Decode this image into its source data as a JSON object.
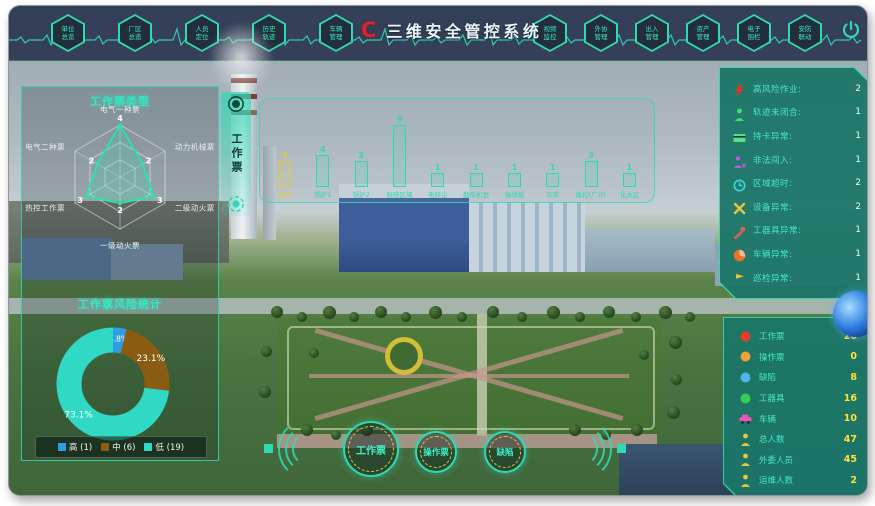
{
  "app": {
    "logo_text": "C",
    "title": "三维安全管控系统"
  },
  "top_nav": {
    "left_items": [
      {
        "label": "单位总览"
      },
      {
        "label": "厂区总览"
      },
      {
        "label": "人员定位"
      },
      {
        "label": "历史轨迹"
      },
      {
        "label": "车辆管理"
      }
    ],
    "right_items": [
      {
        "label": "视频监控"
      },
      {
        "label": "外协管理"
      },
      {
        "label": "出入管理"
      },
      {
        "label": "资产管理"
      },
      {
        "label": "电子围栏"
      },
      {
        "label": "安防联动"
      }
    ]
  },
  "side_tab": {
    "label": "工作票"
  },
  "chart_data": [
    {
      "type": "radar",
      "title": "工作票类型",
      "categories": [
        "电气一种票",
        "动力机械票",
        "二级动火票",
        "一级动火票",
        "热控工作票",
        "电气二种票"
      ],
      "values": [
        4,
        2,
        3,
        2,
        3,
        2
      ],
      "max": 4,
      "line_color": "#2fe0a8"
    },
    {
      "type": "pie",
      "title": "工作票风险统计",
      "labels": [
        "高",
        "中",
        "低"
      ],
      "counts": [
        1,
        6,
        19
      ],
      "percent_labels": [
        "3.8%",
        "23.1%",
        "73.1%"
      ],
      "colors": [
        "#2e9fe6",
        "#8a5c12",
        "#2fd9c3"
      ],
      "legend": [
        "高 (1)",
        "中 (6)",
        "低 (19)"
      ],
      "donut": true
    },
    {
      "type": "bar",
      "title": "",
      "categories": [
        "栈桥",
        "锅炉1",
        "锅炉2",
        "脱硫区域",
        "电除尘",
        "翻车机室",
        "输煤楼",
        "灰库",
        "集控(厂)外",
        "化水区"
      ],
      "values": [
        3,
        4,
        3,
        9,
        1,
        1,
        1,
        1,
        3,
        1
      ],
      "colors": [
        "#e8c63f",
        "#2fd9b5",
        "#2fd9b5",
        "#2fd9b5",
        "#2fd9b5",
        "#2fd9b5",
        "#2fd9b5",
        "#2fd9b5",
        "#2fd9b5",
        "#2fd9b5"
      ]
    }
  ],
  "alarm_panel": {
    "items": [
      {
        "icon": "high-voltage",
        "color": "#e53227",
        "label": "高风险作业:",
        "value": 2
      },
      {
        "icon": "person",
        "color": "#3ae06e",
        "label": "轨迹未闭合:",
        "value": 1
      },
      {
        "icon": "card",
        "color": "#57e08a",
        "label": "持卡异常:",
        "value": 1
      },
      {
        "icon": "intruder",
        "color": "#c05ae0",
        "label": "非法闯入:",
        "value": 1
      },
      {
        "icon": "clock",
        "color": "#3ad6e0",
        "label": "区域超时:",
        "value": 2
      },
      {
        "icon": "wrench",
        "color": "#e8c63f",
        "label": "设备异常:",
        "value": 2
      },
      {
        "icon": "tool",
        "color": "#e0604a",
        "label": "工器具异常:",
        "value": 1
      },
      {
        "icon": "vehicle",
        "color": "#e87427",
        "label": "车辆异常:",
        "value": 1
      },
      {
        "icon": "patrol",
        "color": "#e8c63f",
        "label": "巡检异常:",
        "value": 1
      }
    ]
  },
  "stats_panel": {
    "items": [
      {
        "icon": "dot",
        "color": "#e83a2a",
        "label": "工作票",
        "value": 26
      },
      {
        "icon": "dot",
        "color": "#f0a03a",
        "label": "操作票",
        "value": 0
      },
      {
        "icon": "dot",
        "color": "#4ab8e8",
        "label": "缺陷",
        "value": 8
      },
      {
        "icon": "dot",
        "color": "#35d052",
        "label": "工器具",
        "value": 16
      },
      {
        "icon": "car",
        "color": "#e858b0",
        "label": "车辆",
        "value": 10
      },
      {
        "icon": "person",
        "color": "#e8c63f",
        "label": "总人数",
        "value": 47
      },
      {
        "icon": "person",
        "color": "#e8c63f",
        "label": "外委人员",
        "value": 45
      },
      {
        "icon": "person",
        "color": "#e8c63f",
        "label": "运维人数",
        "value": 2
      }
    ]
  },
  "bottom_buttons": [
    {
      "label": "工作票"
    },
    {
      "label": "操作票"
    },
    {
      "label": "缺陷"
    }
  ]
}
